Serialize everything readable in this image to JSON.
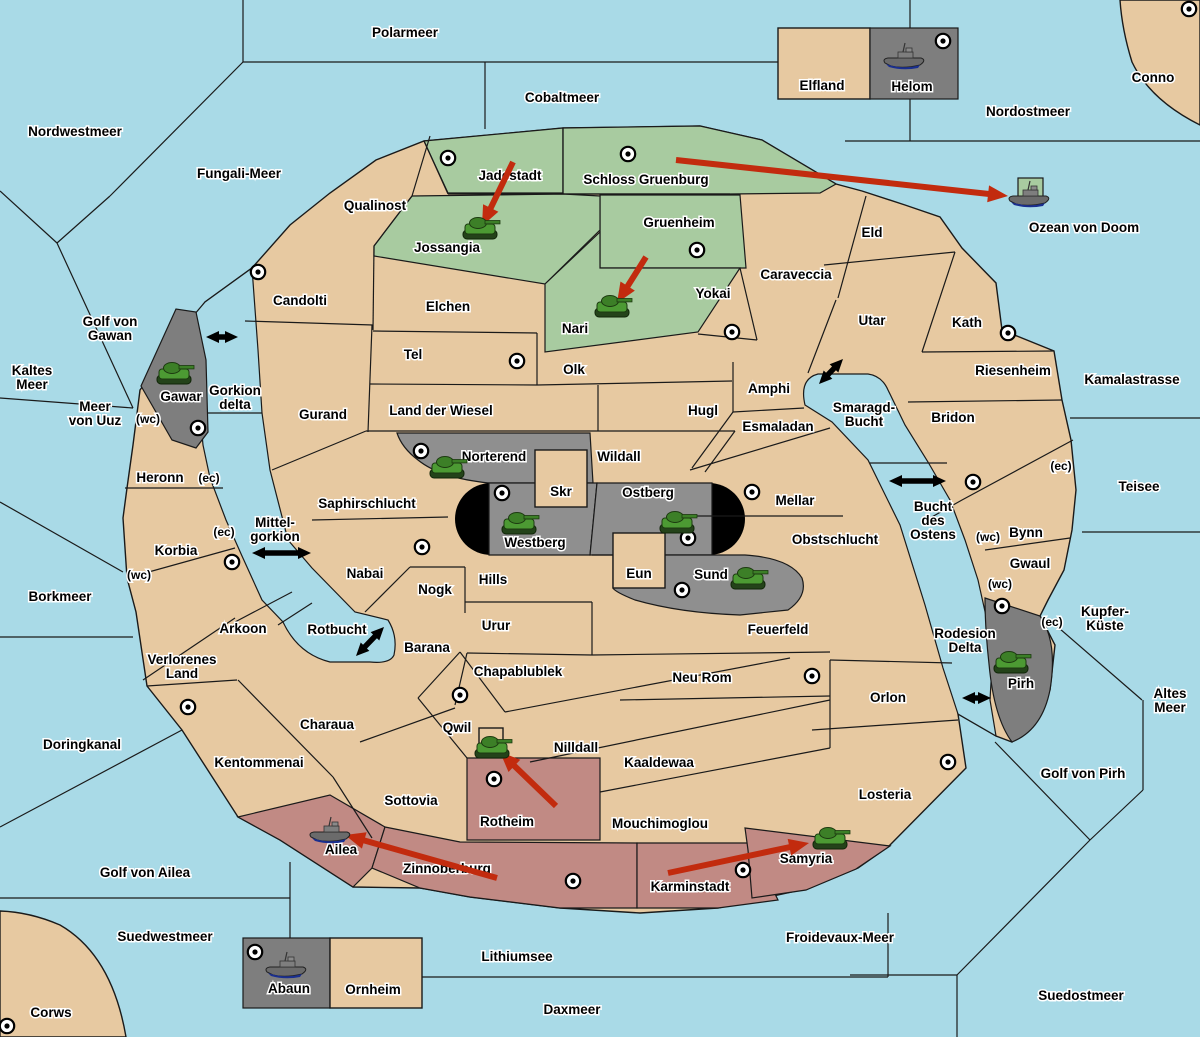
{
  "map": {
    "width": 1200,
    "height": 1037
  },
  "colors": {
    "sea": "#A9DAE7",
    "land": "#E7C9A1",
    "green": "#A8CBA0",
    "gray": "#8F8F8F",
    "dark_gray": "#7E7E7E",
    "red_land": "#C18A84",
    "pill_black": "#000000",
    "arrow_red": "#C22B0E",
    "link_arrow_black": "#000000",
    "supply_center_fill": "#FFFFFF",
    "tank_green": "#4C9A33",
    "ship_gray": "#6B6B6B",
    "ship_keel_navy": "#1A2F8F"
  },
  "sea_labels": [
    {
      "text": "Polarmeer",
      "x": 405,
      "y": 37
    },
    {
      "text": "Nordwestmeer",
      "x": 75,
      "y": 136
    },
    {
      "text": "Cobaltmeer",
      "x": 562,
      "y": 102
    },
    {
      "text": "Fungali-Meer",
      "x": 239,
      "y": 178
    },
    {
      "text": "Nordostmeer",
      "x": 1028,
      "y": 116
    },
    {
      "text": "Conno",
      "x": 1153,
      "y": 82
    },
    {
      "text": "Ozean von Doom",
      "x": 1084,
      "y": 232
    },
    {
      "text": "Kamalastrasse",
      "x": 1132,
      "y": 384
    },
    {
      "text": "Teisee",
      "x": 1139,
      "y": 491
    },
    {
      "lines": [
        "Kupfer-",
        "Küste"
      ],
      "x": 1105,
      "y": 616
    },
    {
      "lines": [
        "Altes",
        "Meer"
      ],
      "x": 1170,
      "y": 698
    },
    {
      "text": "Golf von Pirh",
      "x": 1083,
      "y": 778
    },
    {
      "text": "Suedostmeer",
      "x": 1081,
      "y": 1000
    },
    {
      "text": "Froidevaux-Meer",
      "x": 840,
      "y": 942
    },
    {
      "text": "Daxmeer",
      "x": 572,
      "y": 1014
    },
    {
      "text": "Lithiumsee",
      "x": 517,
      "y": 961
    },
    {
      "text": "Suedwestmeer",
      "x": 165,
      "y": 941
    },
    {
      "text": "Corws",
      "x": 51,
      "y": 1017
    },
    {
      "text": "Golf von Ailea",
      "x": 145,
      "y": 877
    },
    {
      "text": "Doringkanal",
      "x": 82,
      "y": 749
    },
    {
      "text": "Borkmeer",
      "x": 60,
      "y": 601
    },
    {
      "lines": [
        "Kaltes",
        "Meer"
      ],
      "x": 32,
      "y": 375
    },
    {
      "lines": [
        "Golf von",
        "Gawan"
      ],
      "x": 110,
      "y": 326
    },
    {
      "lines": [
        "Meer",
        "von Uuz"
      ],
      "x": 95,
      "y": 411
    },
    {
      "lines": [
        "Gorkion",
        "delta"
      ],
      "x": 235,
      "y": 395
    },
    {
      "lines": [
        "Mittel-",
        "gorkion"
      ],
      "x": 275,
      "y": 527
    },
    {
      "text": "Rotbucht",
      "x": 337,
      "y": 634
    },
    {
      "lines": [
        "Smaragd-",
        "Bucht"
      ],
      "x": 864,
      "y": 412
    },
    {
      "lines": [
        "Bucht",
        "des",
        "Ostens"
      ],
      "x": 933,
      "y": 511
    },
    {
      "lines": [
        "Rodesion",
        "Delta"
      ],
      "x": 965,
      "y": 638
    }
  ],
  "territory_labels": [
    {
      "text": "Qualinost",
      "x": 375,
      "y": 210
    },
    {
      "text": "Jadestadt",
      "x": 510,
      "y": 180
    },
    {
      "text": "Schloss Gruenburg",
      "x": 646,
      "y": 184
    },
    {
      "text": "Gruenheim",
      "x": 679,
      "y": 227
    },
    {
      "text": "Jossangia",
      "x": 447,
      "y": 252
    },
    {
      "text": "Nari",
      "x": 575,
      "y": 333
    },
    {
      "text": "Elchen",
      "x": 448,
      "y": 311
    },
    {
      "text": "Candolti",
      "x": 300,
      "y": 305
    },
    {
      "text": "Tel",
      "x": 413,
      "y": 359
    },
    {
      "text": "Olk",
      "x": 574,
      "y": 374
    },
    {
      "text": "Yokai",
      "x": 713,
      "y": 298
    },
    {
      "text": "Caraveccia",
      "x": 796,
      "y": 279
    },
    {
      "text": "Eld",
      "x": 872,
      "y": 237
    },
    {
      "text": "Utar",
      "x": 872,
      "y": 325
    },
    {
      "text": "Kath",
      "x": 967,
      "y": 327
    },
    {
      "text": "Riesenheim",
      "x": 1013,
      "y": 375
    },
    {
      "text": "Bridon",
      "x": 953,
      "y": 422
    },
    {
      "text": "Amphi",
      "x": 769,
      "y": 393
    },
    {
      "text": "Esmaladan",
      "x": 778,
      "y": 431
    },
    {
      "text": "Hugl",
      "x": 703,
      "y": 415
    },
    {
      "text": "Land der Wiesel",
      "x": 441,
      "y": 415
    },
    {
      "text": "Gurand",
      "x": 323,
      "y": 419
    },
    {
      "text": "Wildall",
      "x": 619,
      "y": 461
    },
    {
      "text": "Norterend",
      "x": 494,
      "y": 461
    },
    {
      "text": "Skr",
      "x": 561,
      "y": 496
    },
    {
      "text": "Ostberg",
      "x": 648,
      "y": 497
    },
    {
      "text": "Westberg",
      "x": 535,
      "y": 547
    },
    {
      "text": "Eun",
      "x": 639,
      "y": 578
    },
    {
      "text": "Sund",
      "x": 711,
      "y": 579
    },
    {
      "text": "Mellar",
      "x": 795,
      "y": 505
    },
    {
      "text": "Obstschlucht",
      "x": 835,
      "y": 544
    },
    {
      "text": "Saphirschlucht",
      "x": 367,
      "y": 508
    },
    {
      "text": "Hills",
      "x": 493,
      "y": 584
    },
    {
      "text": "Nogk",
      "x": 435,
      "y": 594
    },
    {
      "text": "Nabai",
      "x": 365,
      "y": 578
    },
    {
      "text": "Heronn",
      "x": 160,
      "y": 482
    },
    {
      "text": "Korbia",
      "x": 176,
      "y": 555
    },
    {
      "text": "Arkoon",
      "x": 243,
      "y": 633
    },
    {
      "lines": [
        "Verlorenes",
        "Land"
      ],
      "x": 182,
      "y": 664
    },
    {
      "text": "Charaua",
      "x": 327,
      "y": 729
    },
    {
      "text": "Kentommenai",
      "x": 259,
      "y": 767
    },
    {
      "text": "Urur",
      "x": 496,
      "y": 630
    },
    {
      "text": "Barana",
      "x": 427,
      "y": 652
    },
    {
      "text": "Chapablublek",
      "x": 518,
      "y": 676
    },
    {
      "text": "Neu Rom",
      "x": 702,
      "y": 682
    },
    {
      "text": "Feuerfeld",
      "x": 778,
      "y": 634
    },
    {
      "text": "Qwil",
      "x": 457,
      "y": 732
    },
    {
      "text": "Nilldall",
      "x": 576,
      "y": 752
    },
    {
      "text": "Kaaldewaa",
      "x": 659,
      "y": 767
    },
    {
      "text": "Mouchimoglou",
      "x": 660,
      "y": 828
    },
    {
      "text": "Sottovia",
      "x": 411,
      "y": 805
    },
    {
      "text": "Rotheim",
      "x": 507,
      "y": 826
    },
    {
      "text": "Zinnoberburg",
      "x": 447,
      "y": 873
    },
    {
      "text": "Karminstadt",
      "x": 690,
      "y": 891
    },
    {
      "text": "Samyria",
      "x": 806,
      "y": 863
    },
    {
      "text": "Ailea",
      "x": 341,
      "y": 854
    },
    {
      "text": "Losteria",
      "x": 885,
      "y": 799
    },
    {
      "text": "Orlon",
      "x": 888,
      "y": 702
    },
    {
      "text": "Pirh",
      "x": 1021,
      "y": 688
    },
    {
      "text": "Bynn",
      "x": 1026,
      "y": 537
    },
    {
      "text": "Gwaul",
      "x": 1030,
      "y": 568
    },
    {
      "text": "Gawar",
      "x": 181,
      "y": 401
    },
    {
      "text": "Elfland",
      "x": 822,
      "y": 90
    },
    {
      "text": "Helom",
      "x": 912,
      "y": 91
    },
    {
      "text": "Abaun",
      "x": 289,
      "y": 993
    },
    {
      "text": "Ornheim",
      "x": 373,
      "y": 994
    }
  ],
  "coast_labels": [
    {
      "text": "(wc)",
      "x": 148,
      "y": 423
    },
    {
      "text": "(ec)",
      "x": 209,
      "y": 482
    },
    {
      "text": "(ec)",
      "x": 224,
      "y": 536
    },
    {
      "text": "(wc)",
      "x": 139,
      "y": 579
    },
    {
      "text": "(ec)",
      "x": 1061,
      "y": 470
    },
    {
      "text": "(wc)",
      "x": 988,
      "y": 541
    },
    {
      "text": "(wc)",
      "x": 1000,
      "y": 588
    },
    {
      "text": "(ec)",
      "x": 1052,
      "y": 626
    }
  ],
  "supply_centers": [
    {
      "x": 258,
      "y": 272
    },
    {
      "x": 448,
      "y": 158
    },
    {
      "x": 628,
      "y": 154
    },
    {
      "x": 697,
      "y": 250
    },
    {
      "x": 1189,
      "y": 9
    },
    {
      "x": 943,
      "y": 41
    },
    {
      "x": 732,
      "y": 332
    },
    {
      "x": 517,
      "y": 361
    },
    {
      "x": 1008,
      "y": 333
    },
    {
      "x": 973,
      "y": 482
    },
    {
      "x": 198,
      "y": 428
    },
    {
      "x": 232,
      "y": 562
    },
    {
      "x": 421,
      "y": 451
    },
    {
      "x": 502,
      "y": 493
    },
    {
      "x": 688,
      "y": 538
    },
    {
      "x": 682,
      "y": 590
    },
    {
      "x": 752,
      "y": 492
    },
    {
      "x": 188,
      "y": 707
    },
    {
      "x": 460,
      "y": 695
    },
    {
      "x": 812,
      "y": 676
    },
    {
      "x": 948,
      "y": 762
    },
    {
      "x": 494,
      "y": 779
    },
    {
      "x": 573,
      "y": 881
    },
    {
      "x": 743,
      "y": 870
    },
    {
      "x": 1002,
      "y": 606
    },
    {
      "x": 255,
      "y": 952
    },
    {
      "x": 7,
      "y": 1026
    },
    {
      "x": 422,
      "y": 547
    }
  ],
  "units": [
    {
      "type": "tank",
      "location": "Jossangia",
      "x": 480,
      "y": 230
    },
    {
      "type": "tank",
      "location": "Nari",
      "x": 612,
      "y": 308
    },
    {
      "type": "tank",
      "location": "Gawar",
      "x": 174,
      "y": 375
    },
    {
      "type": "tank",
      "location": "Norterend",
      "x": 447,
      "y": 469
    },
    {
      "type": "tank",
      "location": "Westberg",
      "x": 519,
      "y": 525
    },
    {
      "type": "tank",
      "location": "Ostberg",
      "x": 677,
      "y": 524
    },
    {
      "type": "tank",
      "location": "Sund",
      "x": 748,
      "y": 580
    },
    {
      "type": "tank",
      "location": "Pirh",
      "x": 1011,
      "y": 664
    },
    {
      "type": "tank",
      "location": "Qwil",
      "x": 492,
      "y": 749
    },
    {
      "type": "tank",
      "location": "Samyria",
      "x": 830,
      "y": 840
    },
    {
      "type": "ship",
      "location": "Ozean von Doom",
      "x": 1030,
      "y": 197
    },
    {
      "type": "ship",
      "location": "Ailea",
      "x": 331,
      "y": 833
    },
    {
      "type": "ship",
      "location": "Helom",
      "x": 905,
      "y": 59
    },
    {
      "type": "ship",
      "location": "Abaun",
      "x": 287,
      "y": 968
    }
  ],
  "move_arrows": [
    {
      "x1": 513,
      "y1": 162,
      "x2": 482,
      "y2": 226
    },
    {
      "x1": 676,
      "y1": 160,
      "x2": 1008,
      "y2": 196
    },
    {
      "x1": 646,
      "y1": 257,
      "x2": 617,
      "y2": 303
    },
    {
      "x1": 556,
      "y1": 806,
      "x2": 500,
      "y2": 752
    },
    {
      "x1": 668,
      "y1": 873,
      "x2": 809,
      "y2": 843
    },
    {
      "x1": 497,
      "y1": 878,
      "x2": 345,
      "y2": 835
    }
  ],
  "link_arrows": [
    {
      "x1": 206,
      "y1": 337,
      "x2": 238,
      "y2": 337
    },
    {
      "x1": 252,
      "y1": 553,
      "x2": 311,
      "y2": 553
    },
    {
      "x1": 356,
      "y1": 656,
      "x2": 384,
      "y2": 627
    },
    {
      "x1": 819,
      "y1": 384,
      "x2": 843,
      "y2": 359
    },
    {
      "x1": 889,
      "y1": 481,
      "x2": 946,
      "y2": 481
    },
    {
      "x1": 962,
      "y1": 698,
      "x2": 991,
      "y2": 698
    }
  ]
}
